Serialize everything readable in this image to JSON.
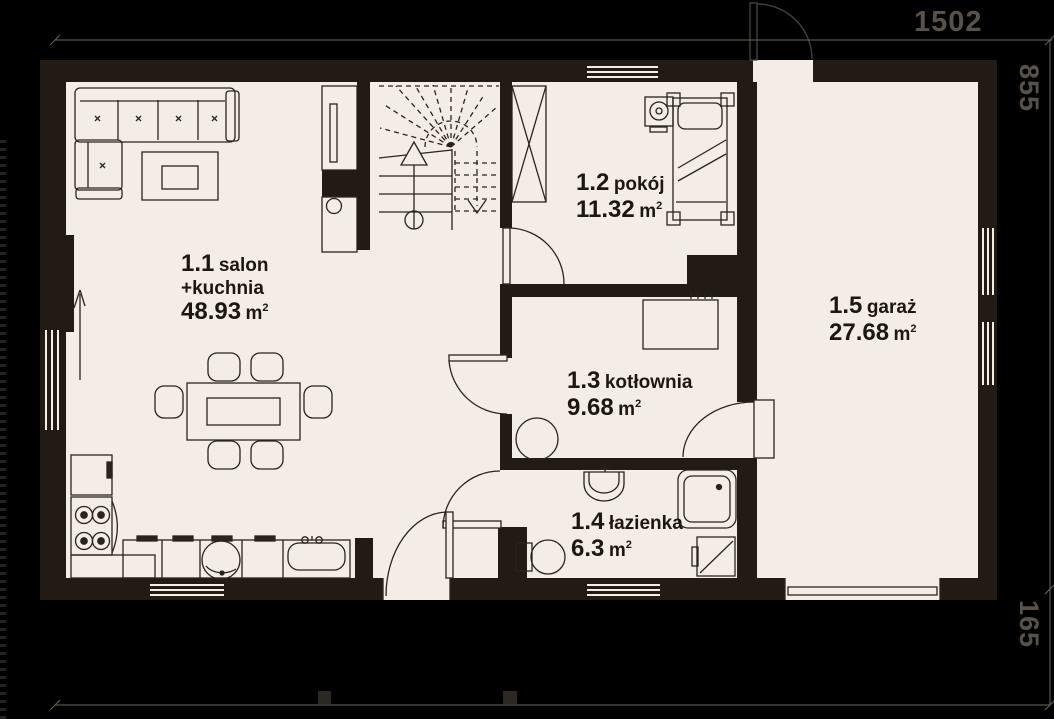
{
  "meta": {
    "unit": "m",
    "sup": "2"
  },
  "dimensions": {
    "top": "1502",
    "right_upper": "855",
    "right_lower": "165"
  },
  "rooms": [
    {
      "id": "1.1",
      "name": "salon",
      "name2": "+kuchnia",
      "area": "48.93"
    },
    {
      "id": "1.2",
      "name": "pokój",
      "area": "11.32"
    },
    {
      "id": "1.3",
      "name": "kotłownia",
      "area": "9.68"
    },
    {
      "id": "1.4",
      "name": "łazienka",
      "area": "6.3"
    },
    {
      "id": "1.5",
      "name": "garaż",
      "area": "27.68"
    }
  ],
  "colors": {
    "background": "#000000",
    "floor": "#f3ede5",
    "wall": "#221b15",
    "furniture_line": "#2b231c",
    "dim_line": "#6b645c",
    "dim_text": "#58524b",
    "label_text": "#1d1712"
  },
  "fixtures": [
    "corner-sofa",
    "coffee-table",
    "dining-table",
    "chairs",
    "fridge",
    "stove",
    "kitchen-counter",
    "kitchen-sink",
    "stairs",
    "wardrobe",
    "bed",
    "nightstand",
    "boiler",
    "water-heater",
    "washbasin",
    "toilet",
    "shower",
    "washing-machine",
    "doors",
    "windows",
    "direction-arrow"
  ]
}
